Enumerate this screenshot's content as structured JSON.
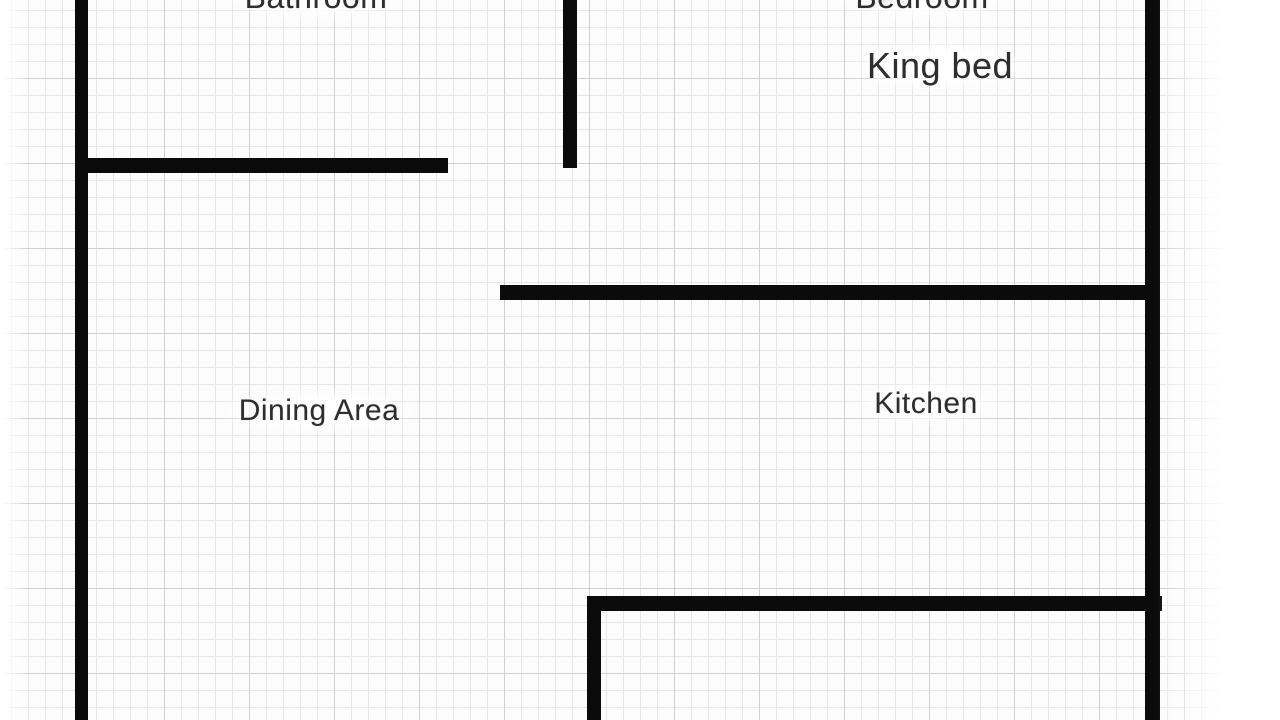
{
  "labels": {
    "bathroom": "Bathroom",
    "bedroom": "Bedroom",
    "king_bed": "King bed",
    "dining_area": "Dining Area",
    "kitchen": "Kitchen"
  },
  "colors": {
    "wall": "#0b0b0b",
    "paper": "#fcfcfc",
    "grid_minor": "#e6e6e6",
    "grid_major": "#d0d0d0",
    "text": "#2e2e2e"
  }
}
